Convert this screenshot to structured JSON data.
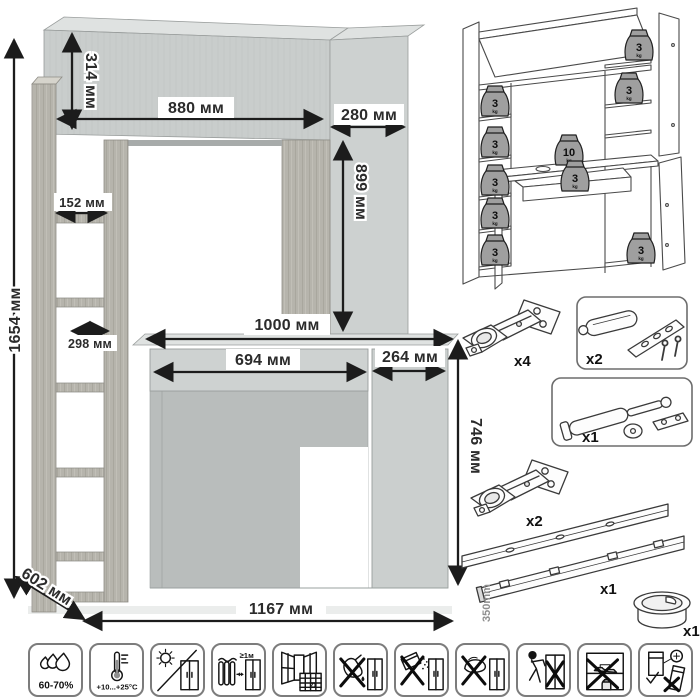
{
  "main_drawing": {
    "unit": "мм",
    "labels": {
      "overall_height": "1654 мм",
      "top_section_height": "314 мм",
      "top_section_width": "880 мм",
      "upper_cabinet_width": "280 мм",
      "upper_cabinet_height": "899 мм",
      "shelf_opening_width": "152 мм",
      "shelf_depth": "298 мм",
      "desktop_width": "1000 мм",
      "drawer_width": "694 мм",
      "lower_cabinet_width": "264 мм",
      "desk_height": "746 мм",
      "depth": "602 мм",
      "overall_width": "1167 мм"
    }
  },
  "load_diagram": {
    "weights": [
      {
        "value": "3",
        "unit": "kg",
        "location": "left-shelf-1"
      },
      {
        "value": "3",
        "unit": "kg",
        "location": "left-shelf-2"
      },
      {
        "value": "3",
        "unit": "kg",
        "location": "left-shelf-3"
      },
      {
        "value": "3",
        "unit": "kg",
        "location": "left-shelf-4"
      },
      {
        "value": "3",
        "unit": "kg",
        "location": "left-shelf-5"
      },
      {
        "value": "3",
        "unit": "kg",
        "location": "top-right-shelf"
      },
      {
        "value": "3",
        "unit": "kg",
        "location": "right-shelf"
      },
      {
        "value": "10",
        "unit": "kg",
        "location": "desktop"
      },
      {
        "value": "3",
        "unit": "kg",
        "location": "drawer"
      },
      {
        "value": "3",
        "unit": "kg",
        "location": "lower-cabinet"
      }
    ]
  },
  "hardware": {
    "items": [
      {
        "name": "concealed-hinge",
        "qty": "x4"
      },
      {
        "name": "door-damper",
        "qty": "x2"
      },
      {
        "name": "gas-lift-strut",
        "qty": "x1"
      },
      {
        "name": "concealed-hinge",
        "qty": "x2"
      },
      {
        "name": "ball-bearing-drawer-slides",
        "qty": "x1",
        "length": "350mm"
      },
      {
        "name": "cable-grommet",
        "qty": "x1"
      }
    ]
  },
  "care_icons": [
    {
      "name": "humidity-range",
      "label": "60-70%"
    },
    {
      "name": "temperature-range",
      "label": "+10...+25°C"
    },
    {
      "name": "avoid-direct-sunlight",
      "label": ""
    },
    {
      "name": "keep-away-from-heat",
      "label": "≥1м"
    },
    {
      "name": "acclimatize-21-days",
      "label": "21"
    },
    {
      "name": "no-aggressive-liquids",
      "label": ""
    },
    {
      "name": "no-abrasive-powders",
      "label": ""
    },
    {
      "name": "no-scouring-tools",
      "label": ""
    },
    {
      "name": "do-not-drag",
      "label": ""
    },
    {
      "name": "do-not-overload",
      "label": ""
    },
    {
      "name": "anchor-to-wall",
      "label": ""
    }
  ]
}
